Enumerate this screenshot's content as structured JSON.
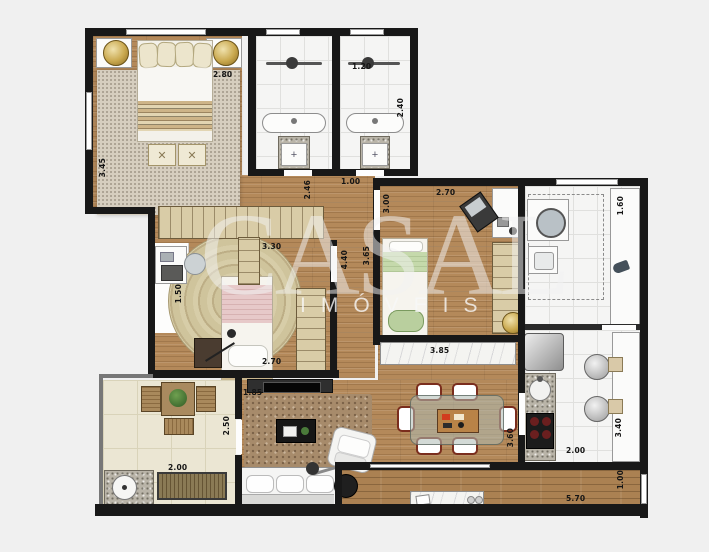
{
  "watermark": {
    "title": "CASAL",
    "subtitle": "IMÓVEIS"
  },
  "glyphs": {
    "bench_cross": "✕",
    "plus": "+"
  },
  "palette": {
    "background": "#f0f0f0",
    "wall": "#181818",
    "wood_floor": "#b4895a",
    "tile_floor": "#f5f5f4",
    "balcony_tile": "#ebe6d3",
    "accent_gold": "#c9a84e",
    "rug_master": "#d6cebf",
    "rug_living": "#a78b6b",
    "bed2_blanket_pink": "#e7c9c9",
    "bed3_blanket_green": "#c5d9ab"
  },
  "dims": {
    "master_width": "2.80",
    "master_depth": "3.45",
    "bath_width": "1.20",
    "bath_depth": "2.40",
    "hall_width": "1.00",
    "hall_depth": "2.46",
    "bedroom2_width": "3.30",
    "bedroom2_bottom": "2.70",
    "corridor_depth": "4.40",
    "nook_width": "1.50",
    "bedroom3_width": "2.70",
    "bedroom3_left": "3.00",
    "bedroom3_right": "3.65",
    "counter_width": "3.85",
    "service_depth": "1.60",
    "kitchen_width": "2.00",
    "kitchen_depth": "3.40",
    "living_top": "1.85",
    "living_depth": "3.60",
    "balcony_depth": "2.50",
    "balcony_width": "2.00",
    "terrace_width": "5.70",
    "terrace_depth": "1.00"
  }
}
